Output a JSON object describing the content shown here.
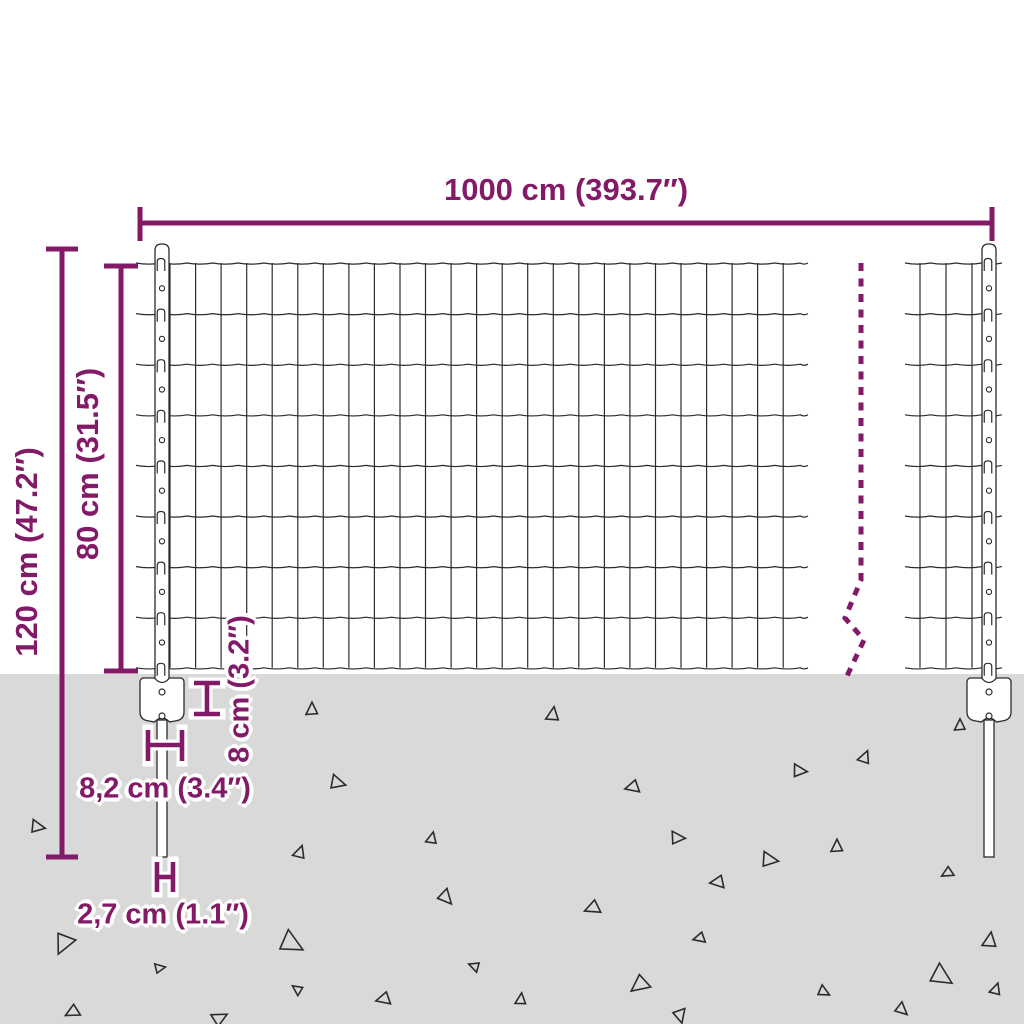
{
  "diagram": {
    "type": "product-dimension-diagram",
    "subject": "wire mesh fence panel with posts and anchor spikes",
    "colors": {
      "dimension": "#821A68",
      "line": "#2d2a2b",
      "ground": "#D9D9D9",
      "background": "#FFFFFF",
      "fill": "#FFFFFF"
    },
    "labels": {
      "total_width": "1000 cm (393.7″)",
      "total_height": "120 cm (47.2″)",
      "panel_height": "80 cm (31.5″)",
      "anchor_plate_height": "8 cm (3.2″)",
      "anchor_plate_width": "8,2 cm (3.4″)",
      "spike_width": "2,7 cm (1.1″)"
    },
    "fence": {
      "mesh_rows": 8,
      "posts": 2,
      "break_line": "dashed-zigzag-continuation",
      "ground_texture": "scattered-outline-triangles"
    }
  }
}
